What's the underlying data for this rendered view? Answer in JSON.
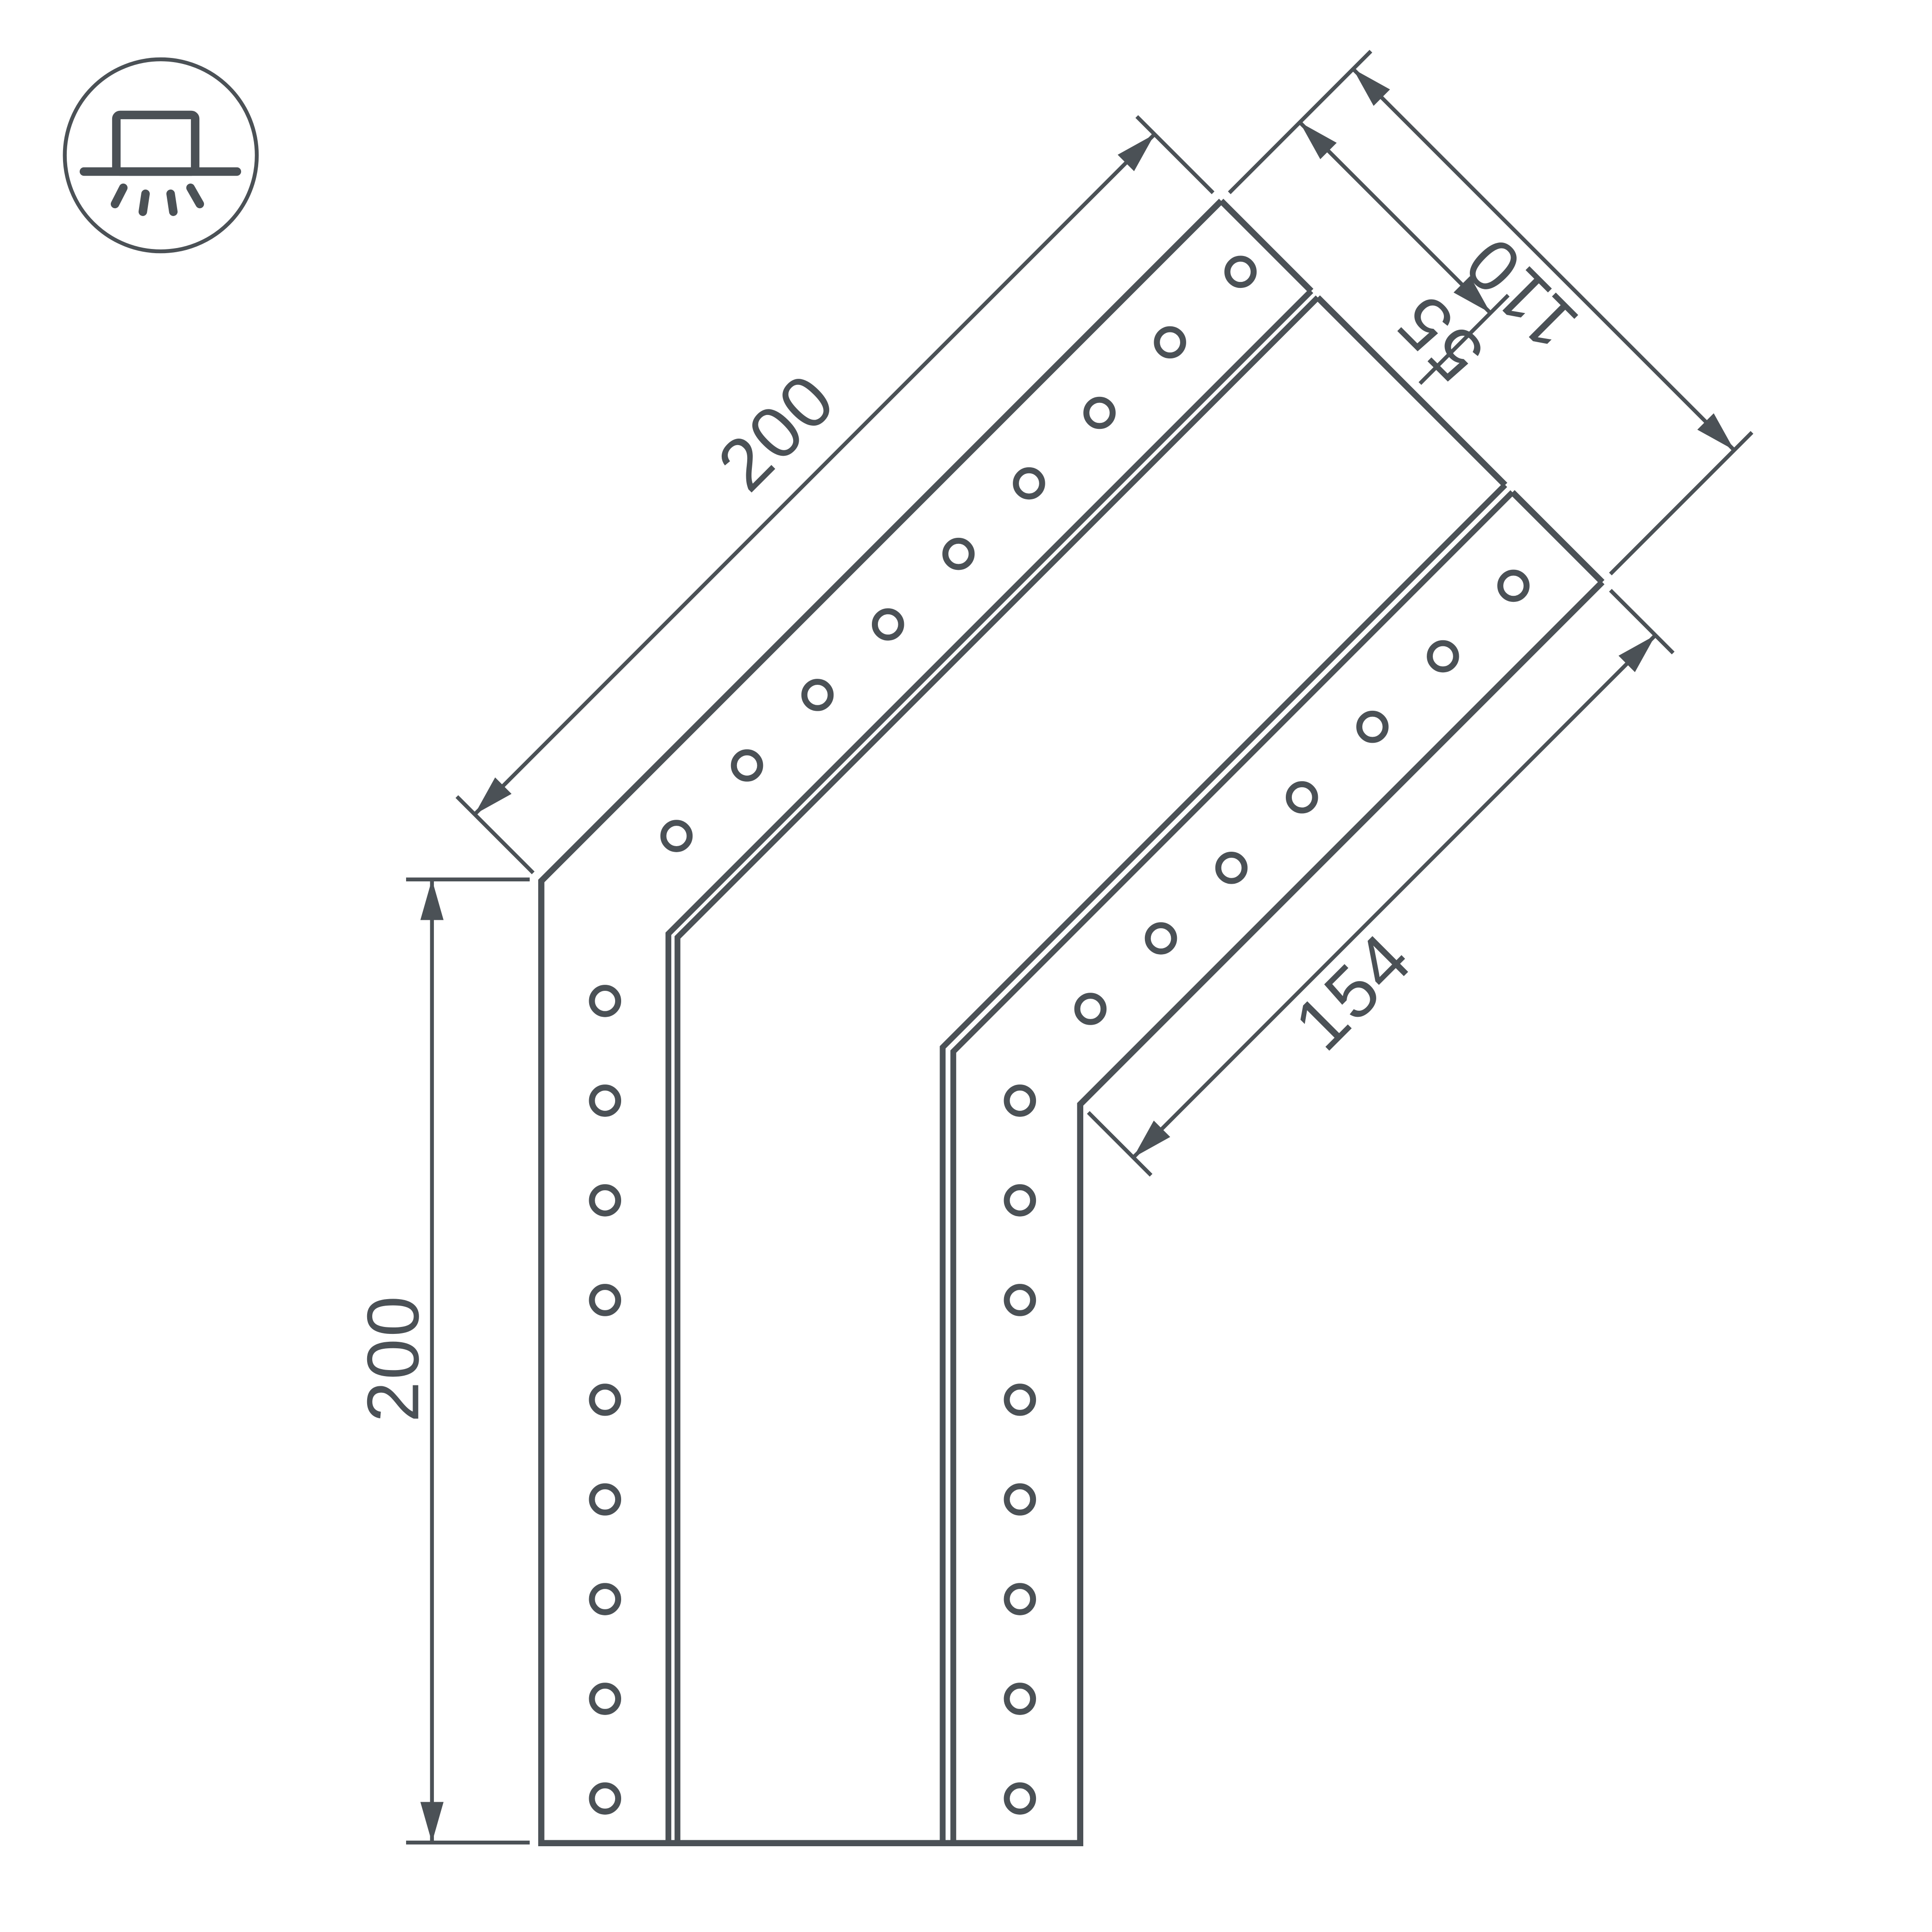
{
  "colors": {
    "line": "#4b5156",
    "background": "#ffffff"
  },
  "icon": {
    "name": "surface-mounted-luminaire-icon"
  },
  "dimensions": {
    "diagonal_leg": "200",
    "vertical_leg": "200",
    "end_width": "110",
    "end_half_width": "55",
    "inner_edge": "154"
  }
}
